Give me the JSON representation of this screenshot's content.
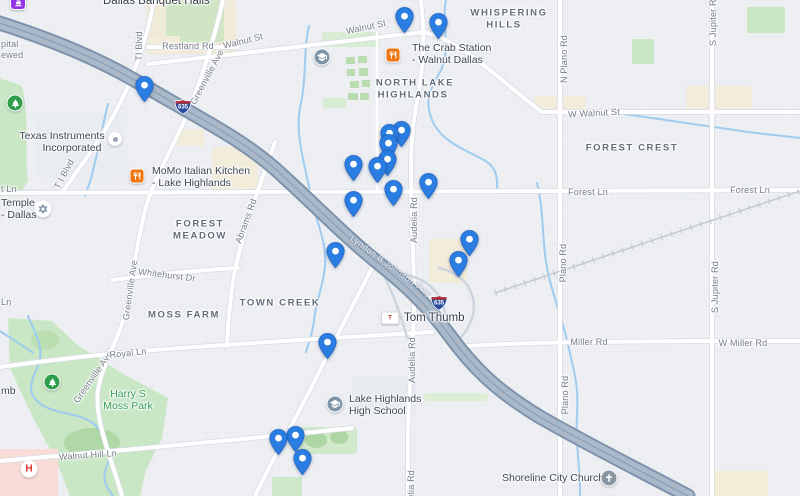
{
  "map": {
    "colors": {
      "pin_blue": "#2a7de1",
      "freeway_gray_blue": "#a9b8c9",
      "park_green": "#c9e7c5",
      "water_blue": "#9ecbf0",
      "restaurant_orange": "#ee7611",
      "hospital_red": "#d93025",
      "banquet_purple": "#9334e6",
      "park_text_green": "#2f9e52"
    },
    "labels": [
      {
        "t": "Restland Rd",
        "x": 188,
        "y": 46
      },
      {
        "t": "Walnut St",
        "x": 243,
        "y": 41,
        "r": -14
      },
      {
        "t": "Walnut St",
        "x": 366,
        "y": 27,
        "r": -12
      },
      {
        "t": "W Walnut St",
        "x": 594,
        "y": 113,
        "r": -3
      },
      {
        "t": "TI Blvd",
        "x": 139,
        "y": 46,
        "r": -90
      },
      {
        "t": "T I Blvd",
        "x": 64,
        "y": 174,
        "r": -62
      },
      {
        "t": "Greenville Ave",
        "x": 207,
        "y": 77,
        "r": -62
      },
      {
        "t": "Greenville Ave",
        "x": 130,
        "y": 290,
        "r": -82
      },
      {
        "t": "Greenville Ave",
        "x": 93,
        "y": 377,
        "r": -55
      },
      {
        "t": "Forest Ln",
        "x": 588,
        "y": 192
      },
      {
        "t": "Forest Ln",
        "x": 750,
        "y": 190
      },
      {
        "t": "t Ln",
        "x": 1,
        "y": 189,
        "cls": "street left"
      },
      {
        "t": "Whitehurst Dr",
        "x": 167,
        "y": 275,
        "r": 7
      },
      {
        "t": "Royal Ln",
        "x": 128,
        "y": 353,
        "r": -6
      },
      {
        "t": "Walnut Hill Ln",
        "x": 88,
        "y": 455,
        "r": -4
      },
      {
        "t": "Miller Rd",
        "x": 589,
        "y": 342
      },
      {
        "t": "W Miller Rd",
        "x": 743,
        "y": 343
      },
      {
        "t": "Audelia Rd",
        "x": 414,
        "y": 220,
        "r": -90
      },
      {
        "t": "Audelia Rd",
        "x": 412,
        "y": 360,
        "r": -90
      },
      {
        "t": "Audelia Rd",
        "x": 411,
        "y": 493,
        "r": -90
      },
      {
        "t": "N Plano Rd",
        "x": 564,
        "y": 59,
        "r": -90
      },
      {
        "t": "Plano Rd",
        "x": 563,
        "y": 263,
        "r": -90
      },
      {
        "t": "Plano Rd",
        "x": 565,
        "y": 395,
        "r": -90
      },
      {
        "t": "S Jupiter Rd",
        "x": 713,
        "y": 20,
        "r": -90
      },
      {
        "t": "S Jupiter Rd",
        "x": 715,
        "y": 287,
        "r": -90
      },
      {
        "t": "Abrams Rd",
        "x": 246,
        "y": 221,
        "r": -70
      },
      {
        "t": "Ln",
        "x": 1,
        "y": 302,
        "cls": "street left"
      },
      {
        "t": "pital",
        "x": 1,
        "y": 44,
        "cls": "street left"
      },
      {
        "t": "ewed",
        "x": 1,
        "y": 55,
        "cls": "street left"
      },
      {
        "t": "Lyndon B Johnson Fwy",
        "x": 391,
        "y": 266,
        "r": 36,
        "cls": "hwy"
      },
      {
        "t": "WHISPERING",
        "x": 509,
        "y": 13,
        "cls": "hood"
      },
      {
        "t": "HILLS",
        "x": 504,
        "y": 25,
        "cls": "hood"
      },
      {
        "t": "NORTH LAKE",
        "x": 415,
        "y": 83,
        "cls": "hood"
      },
      {
        "t": "HIGHLANDS",
        "x": 413,
        "y": 95,
        "cls": "hood"
      },
      {
        "t": "FOREST CREST",
        "x": 632,
        "y": 148,
        "cls": "hood"
      },
      {
        "t": "FOREST",
        "x": 200,
        "y": 224,
        "cls": "hood"
      },
      {
        "t": "MEADOW",
        "x": 200,
        "y": 236,
        "cls": "hood"
      },
      {
        "t": "TOWN CREEK",
        "x": 280,
        "y": 303,
        "cls": "hood"
      },
      {
        "t": "MOSS FARM",
        "x": 184,
        "y": 315,
        "cls": "hood"
      },
      {
        "t": "Dallas Banquet Halls",
        "x": 103,
        "y": 1,
        "cls": "poi left big"
      },
      {
        "t": "Texas Instruments",
        "x": 62,
        "y": 136,
        "cls": "poi"
      },
      {
        "t": "Incorporated",
        "x": 72,
        "y": 148,
        "cls": "poi"
      },
      {
        "t": "MoMo Italian Kitchen",
        "x": 152,
        "y": 171,
        "cls": "poi left"
      },
      {
        "t": "- Lake Highlands",
        "x": 152,
        "y": 183,
        "cls": "poi left"
      },
      {
        "t": "The Crab Station",
        "x": 412,
        "y": 48,
        "cls": "poi left"
      },
      {
        "t": "- Walnut Dallas",
        "x": 412,
        "y": 60,
        "cls": "poi left"
      },
      {
        "t": "Tom Thumb",
        "x": 404,
        "y": 318,
        "cls": "poi left big"
      },
      {
        "t": "mb",
        "x": 1,
        "y": 391,
        "cls": "poi left"
      },
      {
        "t": "Lake Highlands",
        "x": 349,
        "y": 399,
        "cls": "poi left"
      },
      {
        "t": "High School",
        "x": 349,
        "y": 411,
        "cls": "poi left"
      },
      {
        "t": "Temple",
        "x": 1,
        "y": 203,
        "cls": "poi left"
      },
      {
        "t": "- Dallas",
        "x": 1,
        "y": 215,
        "cls": "poi left"
      },
      {
        "t": "Shoreline City Church",
        "x": 502,
        "y": 478,
        "cls": "poi left"
      },
      {
        "t": "Harry S",
        "x": 128,
        "y": 394,
        "cls": "park"
      },
      {
        "t": "Moss Park",
        "x": 128,
        "y": 406,
        "cls": "park"
      }
    ],
    "icons": [
      {
        "type": "banquet",
        "x": 18,
        "y": 2
      },
      {
        "type": "restaurant",
        "x": 137,
        "y": 176
      },
      {
        "type": "restaurant",
        "x": 393,
        "y": 55
      },
      {
        "type": "dot",
        "x": 115,
        "y": 139
      },
      {
        "type": "school",
        "x": 322,
        "y": 57
      },
      {
        "type": "school",
        "x": 335,
        "y": 404
      },
      {
        "type": "park",
        "x": 15,
        "y": 103
      },
      {
        "type": "park",
        "x": 52,
        "y": 382
      },
      {
        "type": "hospital",
        "x": 29,
        "y": 469
      },
      {
        "type": "church",
        "x": 609,
        "y": 478
      },
      {
        "type": "temple",
        "x": 43,
        "y": 209
      },
      {
        "type": "tomthumb",
        "x": 390,
        "y": 318
      }
    ],
    "shields": [
      {
        "x": 183,
        "y": 107,
        "text": "635"
      },
      {
        "x": 439,
        "y": 303,
        "text": "635"
      }
    ],
    "pins": [
      {
        "x": 404,
        "y": 16
      },
      {
        "x": 438,
        "y": 22
      },
      {
        "x": 144,
        "y": 85
      },
      {
        "x": 401,
        "y": 130
      },
      {
        "x": 389,
        "y": 133
      },
      {
        "x": 388,
        "y": 143
      },
      {
        "x": 387,
        "y": 159
      },
      {
        "x": 377,
        "y": 166
      },
      {
        "x": 353,
        "y": 164
      },
      {
        "x": 428,
        "y": 182
      },
      {
        "x": 393,
        "y": 189
      },
      {
        "x": 353,
        "y": 200
      },
      {
        "x": 469,
        "y": 239
      },
      {
        "x": 335,
        "y": 251
      },
      {
        "x": 458,
        "y": 260
      },
      {
        "x": 327,
        "y": 342
      },
      {
        "x": 295,
        "y": 435
      },
      {
        "x": 278,
        "y": 438
      },
      {
        "x": 302,
        "y": 458
      }
    ]
  }
}
